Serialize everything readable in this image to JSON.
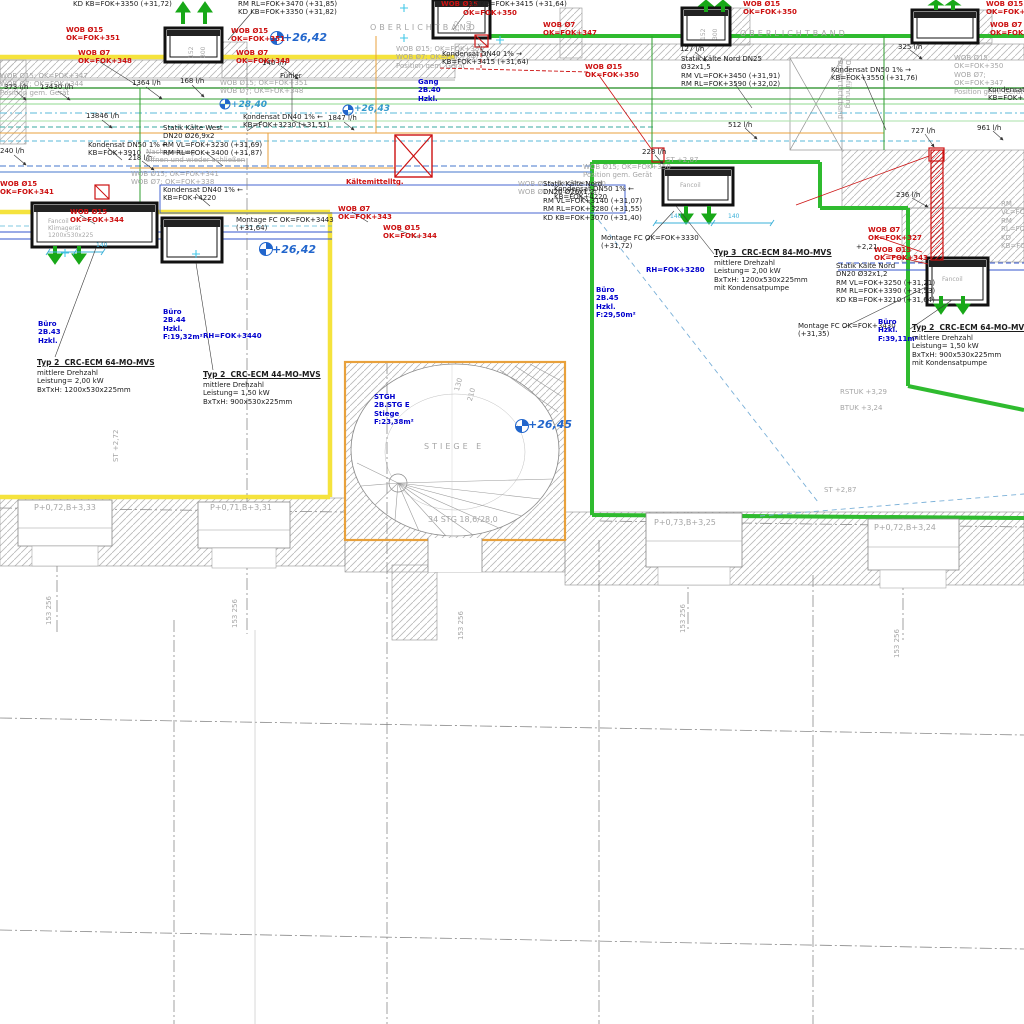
{
  "plan": {
    "colors": {
      "marker_yellow": "#f5e33d",
      "marker_green": "#2fbb2f",
      "pipe_orange": "#e8a13c",
      "pipe_blue": "#3355cc",
      "pipe_cyan": "#58b8d8",
      "refrigerant_red": "#cc1111"
    },
    "levels": {
      "l1": "+26,42",
      "l2": "+26,42",
      "l3": "+26,45",
      "l4": "+28,40",
      "l5": "+26,43"
    },
    "flows": {
      "f1": "373 l/h",
      "f2": "13430 l/h",
      "f3": "13846 l/h",
      "f4": "1364 l/h",
      "f5": "168 l/h",
      "f6": "140 l/h",
      "f7": "1847 l/h",
      "f8": "218 l/h",
      "f9": "240 l/h",
      "f10": "127 l/h",
      "f11": "325 l/h",
      "f12": "512 l/h",
      "f13": "727 l/h",
      "f14": "961 l/h",
      "f15": "236 l/h",
      "f16": "228 l/h"
    },
    "wob": {
      "w1": "WOB Ø15\nOK=FOK+351",
      "w2": "WOB Ø7\nOK=FOK+348",
      "w3": "WOB Ø15\nOK=FOK+351",
      "w4": "WOB Ø7\nOK=FOK+348",
      "w5": "WOB Ø15",
      "w6": "OK=FOK+350",
      "w7": "WOB Ø7\nOK=FOK+347",
      "w8": "WOB Ø15\nOK=FOK+350",
      "w9": "WOB Ø15\nOK=FOK+350",
      "w10": "WOB Ø15\nOK=FOK+350",
      "w11": "WOB Ø7\nOK=FOK+347",
      "w12": "WOB Ø15\nOK=FOK+341",
      "w13": "WOB Ø15\nOK=FOK+344",
      "w14": "WOB Ø7\nOK=FOK+343",
      "w15": "WOB Ø15\nOK=FOK+344",
      "w16": "WOB Ø7\nOK=FOK+327",
      "w17": "WOB Ø15\nOK=FOK+343",
      "w18": "Kältemittelltg."
    },
    "ghost": {
      "g1": "OBERLICHTBAND",
      "g2": "OBERLICHTBAND",
      "g3": "WOB Ø15; OK=FOK+350\nWOB Ø7; OK=FOK+347\nPosition gem. Gerät",
      "g4": "WOB Ø15; OK=FOK+347\nWOB Ø7; OK=FOK+344\nPosition gem. Gerät",
      "g5": "WOB Ø15; OK=FOK+351\nWOB Ø7; OK=FOK+348",
      "g6": "WOB Ø15; OK=FOK+341\nWOB Ø7; OK=FOK+338",
      "g7": "WOB Ø15; OK=FOK+350\nWOB Ø7; OK=FOK+347",
      "g8": "WOB Ø15; OK=FOK+350\nWOB Ø7; OK=FOK+347\nPosition gem. Gerät",
      "g9": "WOB Ø15; OK=FOK+350\nPosition gem. Gerät",
      "g10": "Nachspeisung\nöffnen und wieder schließen",
      "g11": "Durchführung\nBoden Lichtband",
      "g12": "ST +2,87",
      "g13": "ST +2,87",
      "g14": "ST +2,72",
      "g15": "RSTUK +3,29",
      "g16": "BTUK +3,24",
      "g17": "STIEGE E",
      "g18": "34 STG 18,6/28,0",
      "g19": "RM VL=FOK+3250\nRM RL=FOK+3390\nKD KB=FOK+3210",
      "g20": "130",
      "g21": "210"
    },
    "notes": {
      "p1": "KD KB=FOK+3350 (+31,72)",
      "p2": "RM RL=FOK+3470 (+31,85)\nKD KB=FOK+3350 (+31,82)",
      "p3": "KD KB=FOK+3415 (+31,64)",
      "p4": "Kondensat DN40 1% →\nKB=FOK+3415 (+31,64)",
      "p5": "Statik Kälte Nord DN25\nØ32x1,5\nRM VL=FOK+3450 (+31,91)\nRM RL=FOK+3590 (+32,02)",
      "p6": "Kondensat DN50 1% →\nKB=FOK+3550 (+31,76)",
      "p7": "Kondensat DN40 1% ←\nKB=FOK+3230 (+31,51)",
      "p8": "Statik Kälte West\nDN20 Ø26,9x2\nRM VL=FOK+3230 (+31,69)\nRM RL=FOK+3400 (+31,87)",
      "p9": "Kondensat DN50 1% ←\nKB=FOK+3910",
      "p10": "Kondensat DN40 1% ←\nKB=FOK+4220",
      "p11": "Kondensat DN50 1% ←\nKB=FOK+4220",
      "p12": "Montage FC OK=FOK+3443\n(+31,64)",
      "p13": "Statik Kälte Nord\nDN20 Ø26x1,2\nRM VL=FOK+3140 (+31,07)\nRM RL=FOK+3280 (+31,55)\nKD KB=FOK+3070 (+31,40)",
      "p14": "Montage FC OK=FOK+3330\n(+31,72)",
      "p15": "Statik Kälte Nord\nDN20 Ø32x1,2\nRM VL=FOK+3250 (+31,21)\nRM RL=FOK+3390 (+31,53)\nKD KB=FOK+3210 (+31,64)",
      "p16": "Montage FC OK=FOK+3430\n(+31,35)",
      "p17": "+2,21",
      "p18": "Kondensat\nKB=FOK+3550",
      "p19": "Fühler"
    },
    "rooms": {
      "r1": "Büro\n2B.43\nHzkl.",
      "r2": "Büro\n2B.44\nHzkl.\nF:19,32m²",
      "r3": "Gang\n2B.40\nHzkl.",
      "r4": "Büro\n2B.45\nHzkl.\nF:29,50m²",
      "r5": "Büro\nHzkl.\nF:39,11m²",
      "r6": "STGH\n2B.STG E\nStiege\nF:23,38m²",
      "r7": "RH=FOK+3440",
      "r8": "RH=FOK+3280"
    },
    "units": {
      "u1": {
        "heading": "Typ 2  CRC-ECM 64-MO-MVS",
        "specs": "mittlere Drehzahl\nLeistung= 2,00 kW\nBxTxH: 1200x530x225mm"
      },
      "u2": {
        "heading": "Typ 2  CRC-ECM 44-MO-MVS",
        "specs": "mittlere Drehzahl\nLeistung= 1,50 kW\nBxTxH: 900x530x225mm"
      },
      "u3": {
        "heading": "Typ 3  CRC-ECM 84-MO-MVS",
        "specs": "mittlere Drehzahl\nLeistung= 2,00 kW\nBxTxH: 1200x530x225mm\nmit Kondensatpumpe"
      },
      "u4": {
        "heading": "Typ 2  CRC-ECM 64-MO-MVS",
        "specs": "mittlere Drehzahl\nLeistung= 1,50 kW\nBxTxH: 900x530x225mm\nmit Kondensatpumpe"
      },
      "interior": {
        "i1": "Fancoil\nKlimagerät\n1200x530x225",
        "i2": "Fancoil",
        "i3": "Fancoil"
      },
      "dims": {
        "a": "152",
        "b": "300"
      }
    },
    "facade": {
      "win1": "P+0,72,B+3,33",
      "win2": "P+0,71,B+3,31",
      "win3": "P+0,73,B+3,25",
      "win4": "P+0,72,B+3,24",
      "dim_pair": "153  256"
    },
    "cyan_dim": "140"
  }
}
